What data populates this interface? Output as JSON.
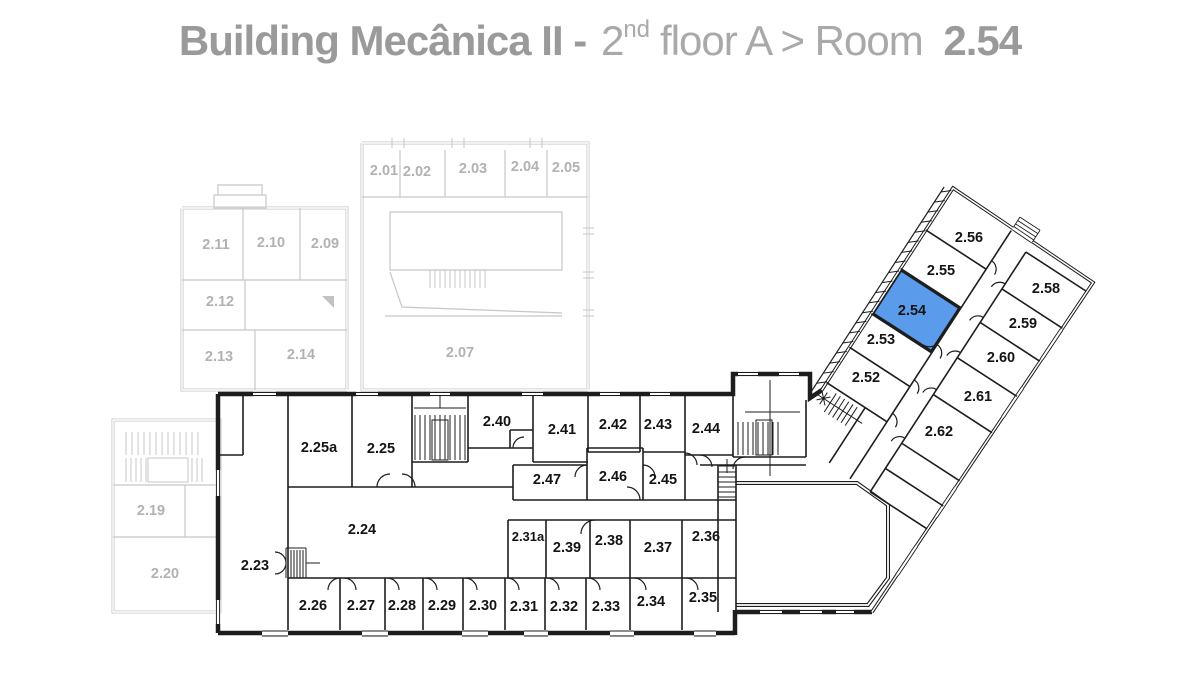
{
  "title": {
    "building": "Building Mecânica II -",
    "floor_number": "2",
    "floor_ordinal": "nd",
    "floor_label": "floor A > Room",
    "room": "2.54"
  },
  "highlighted_room": "2.54",
  "colors": {
    "highlight": "#5b9bec",
    "wall_dark": "#1d1d1d",
    "wall_faded": "#c7c7c7",
    "label_dark": "#141414",
    "label_faded": "#b2b2b2",
    "title_bold": "#9a9a9a",
    "title_light": "#a9a9aa"
  },
  "rooms": {
    "r2_01": "2.01",
    "r2_02": "2.02",
    "r2_03": "2.03",
    "r2_04": "2.04",
    "r2_05": "2.05",
    "r2_07": "2.07",
    "r2_09": "2.09",
    "r2_10": "2.10",
    "r2_11": "2.11",
    "r2_12": "2.12",
    "r2_13": "2.13",
    "r2_14": "2.14",
    "r2_19": "2.19",
    "r2_20": "2.20",
    "r2_23": "2.23",
    "r2_24": "2.24",
    "r2_25": "2.25",
    "r2_25a": "2.25a",
    "r2_26": "2.26",
    "r2_27": "2.27",
    "r2_28": "2.28",
    "r2_29": "2.29",
    "r2_30": "2.30",
    "r2_31": "2.31",
    "r2_31a": "2.31a",
    "r2_32": "2.32",
    "r2_33": "2.33",
    "r2_34": "2.34",
    "r2_35": "2.35",
    "r2_36": "2.36",
    "r2_37": "2.37",
    "r2_38": "2.38",
    "r2_39": "2.39",
    "r2_40": "2.40",
    "r2_41": "2.41",
    "r2_42": "2.42",
    "r2_43": "2.43",
    "r2_44": "2.44",
    "r2_45": "2.45",
    "r2_46": "2.46",
    "r2_47": "2.47",
    "r2_52": "2.52",
    "r2_53": "2.53",
    "r2_54": "2.54",
    "r2_55": "2.55",
    "r2_56": "2.56",
    "r2_58": "2.58",
    "r2_59": "2.59",
    "r2_60": "2.60",
    "r2_61": "2.61",
    "r2_62": "2.62"
  }
}
